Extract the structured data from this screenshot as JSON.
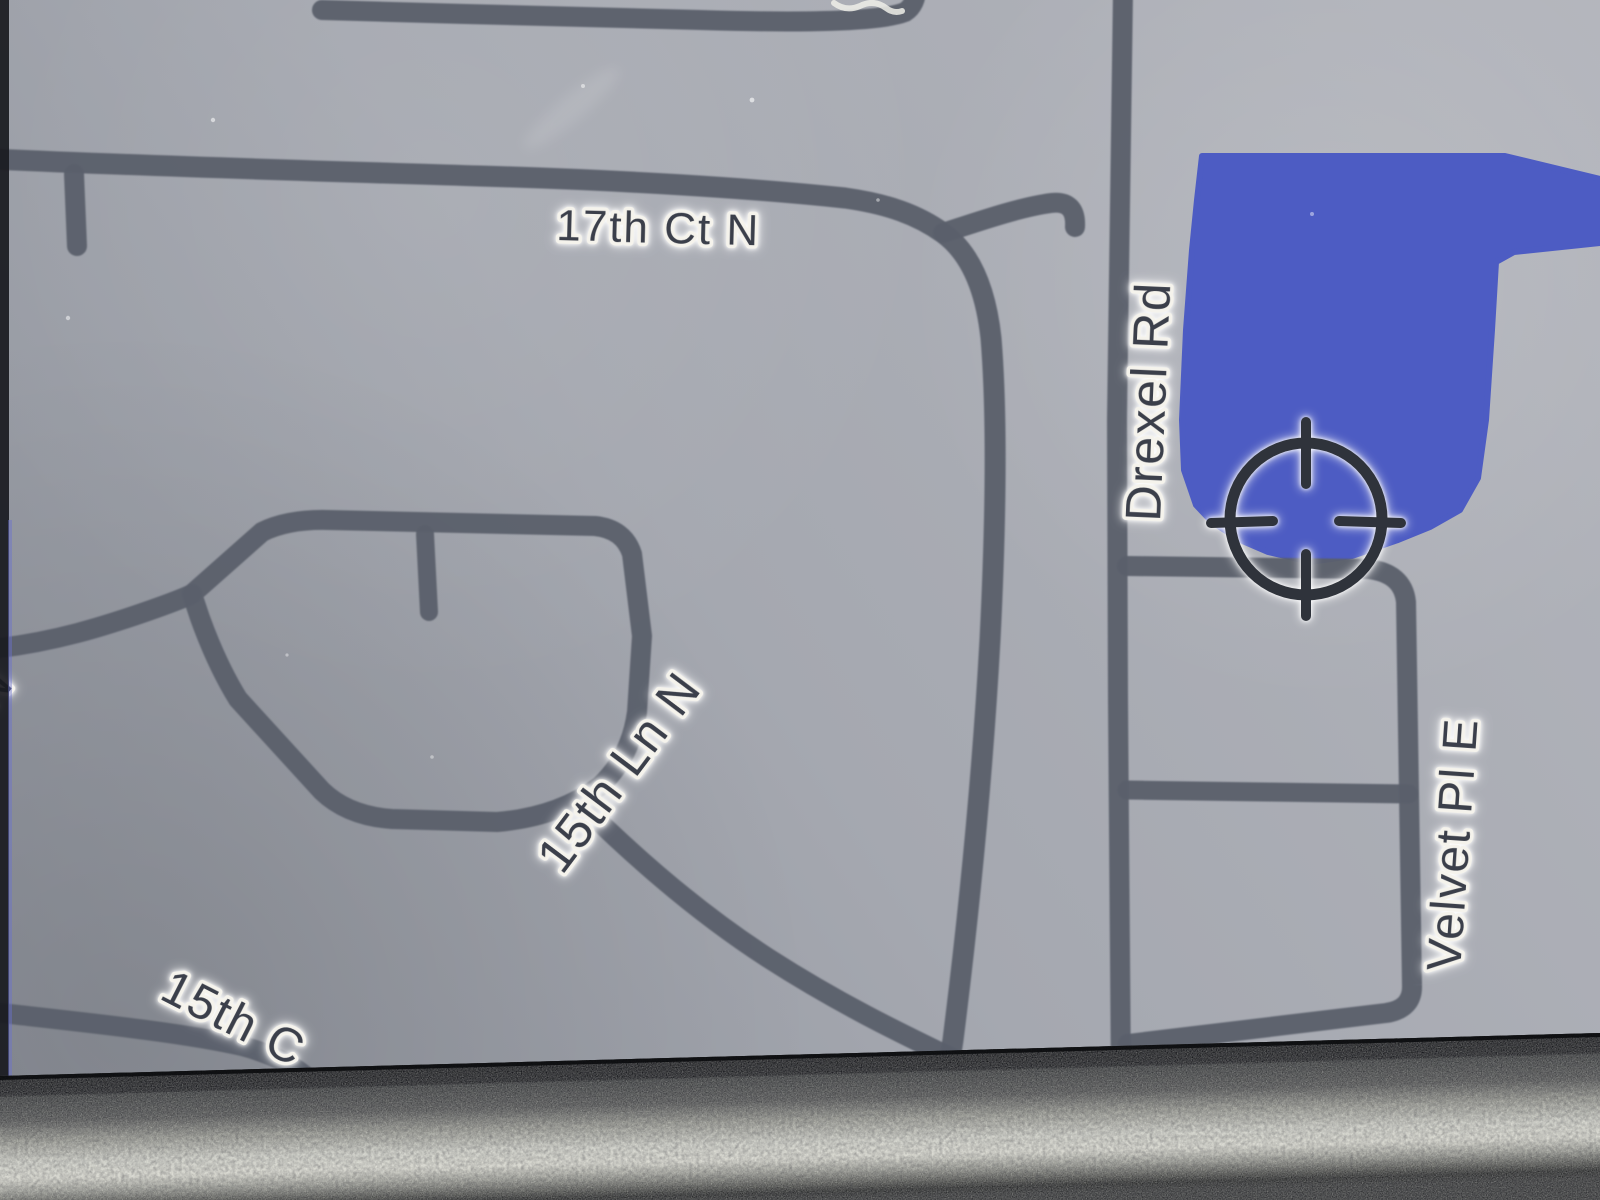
{
  "map": {
    "street_labels": [
      {
        "name": "17th-ct-n",
        "text": "17th Ct N"
      },
      {
        "name": "drexel-rd",
        "text": "Drexel Rd"
      },
      {
        "name": "15th-ln-n",
        "text": "15th Ln N"
      },
      {
        "name": "velvet-pl-e",
        "text": "Velvet Pl E"
      },
      {
        "name": "15th-ct-partial",
        "text": "15th C"
      },
      {
        "name": "street-n-partial",
        "text": "N"
      }
    ],
    "cursor_icon": "crosshair-target",
    "water_feature": "lake",
    "colors": {
      "water": "#4d5cc3",
      "road": "#5b606b",
      "map_background": "#a6a9b1",
      "label_text": "#3b3f4a",
      "label_halo": "#f5f3ec",
      "crosshair": "#2f333b"
    }
  }
}
